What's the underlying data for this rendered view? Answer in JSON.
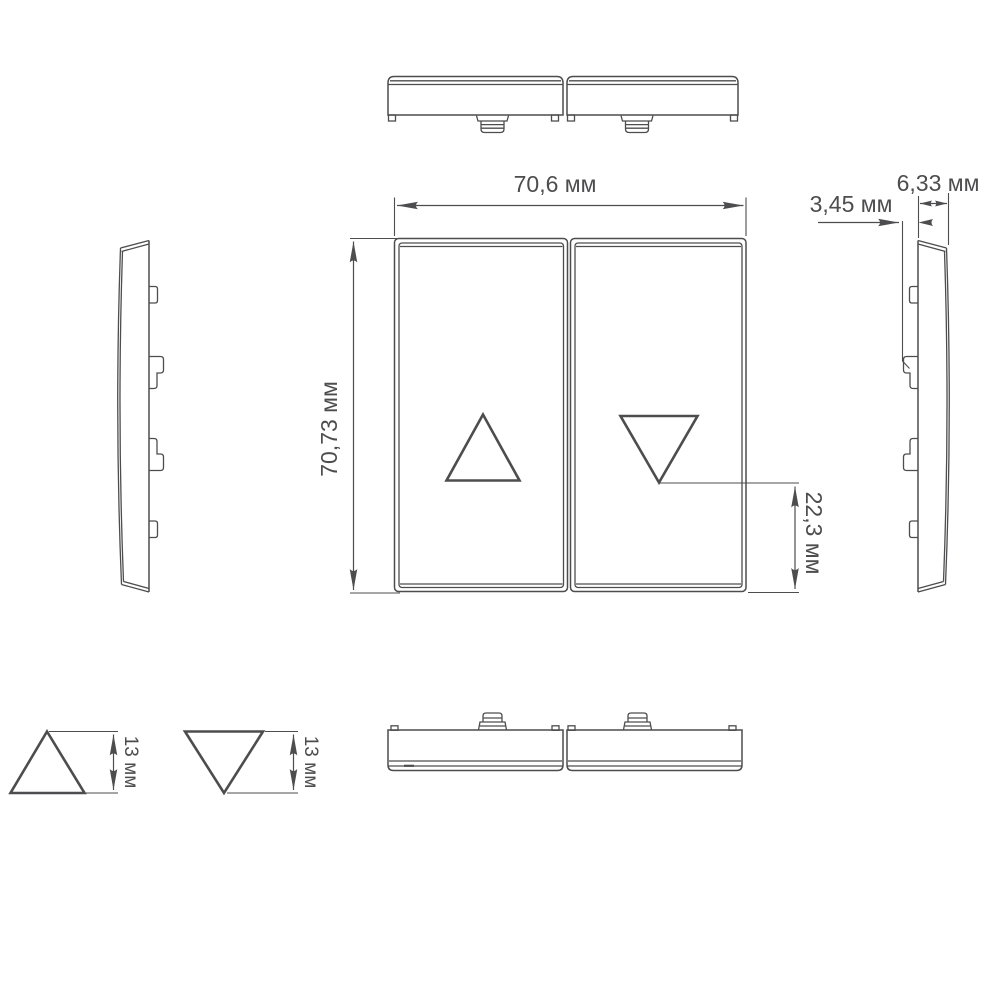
{
  "colors": {
    "line": "#4d4d4f",
    "background": "#ffffff"
  },
  "units": "мм",
  "labels": {
    "front_width": "70,6 мм",
    "front_height": "70,73 мм",
    "down_arrow_offset": "22,3 мм",
    "clip_protrusion": "3,45 мм",
    "profile_depth": "6,33 мм",
    "triangle_up_height": "13 мм",
    "triangle_down_height": "13 мм"
  }
}
